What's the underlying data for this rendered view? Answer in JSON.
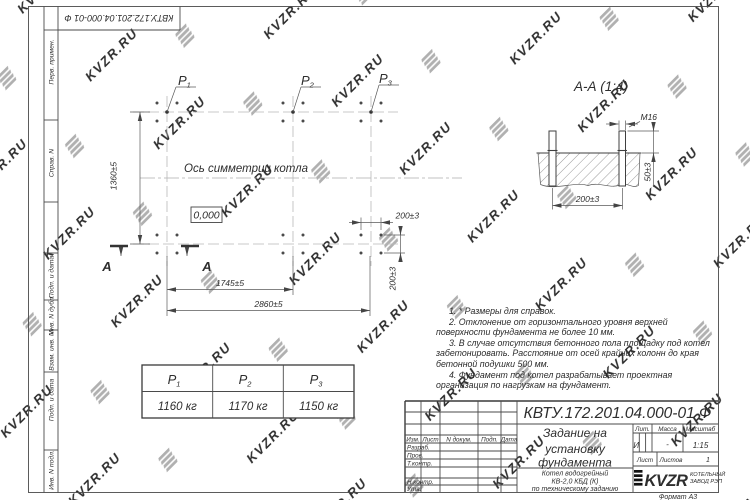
{
  "watermark": {
    "text": "KVZR.RU"
  },
  "designation": "КВТУ.172.201.04.000-01 Ф",
  "margins": {
    "labels": [
      "Перв. примен.",
      "Справ. N",
      "Подп. и дата",
      "Инв. N дубл.",
      "Взам. инв. N",
      "Подп. и дата",
      "Инв. N подл."
    ]
  },
  "plan": {
    "axis_label": "Ось симметрии котла",
    "elevation": "0,000",
    "section_letter": "А",
    "p_labels": [
      {
        "base": "P",
        "sub": "1"
      },
      {
        "base": "P",
        "sub": "2"
      },
      {
        "base": "P",
        "sub": "3"
      }
    ],
    "dims": {
      "height": "1360±5",
      "span_p1_p2": "1745±5",
      "overall": "2860±5",
      "group_x": "200±3",
      "group_y": "200±3"
    }
  },
  "section": {
    "title": "А-А (1:4)",
    "thread": "М16",
    "protrusion": "50±3",
    "spacing": "200±3"
  },
  "load_table": {
    "headers": [
      {
        "base": "P",
        "sub": "1"
      },
      {
        "base": "P",
        "sub": "2"
      },
      {
        "base": "P",
        "sub": "3"
      }
    ],
    "values": [
      "1160 кг",
      "1170 кг",
      "1150 кг"
    ]
  },
  "notes": [
    "1. * Размеры для справок.",
    "2. Отклонение от горизонтального уровня верхней поверхности фундамента не более 10 мм.",
    "3. В случае отсутствия бетонного пола площадку под котел забетонировать. Расстояние от осей крайних колонн до края бетонной подушки 500 мм.",
    "4. Фундамент под котел разрабатывает проектная организация по нагрузкам на фундамент."
  ],
  "title_block": {
    "change_header": [
      "Изм.",
      "Лист",
      "N докум.",
      "Подп.",
      "Дата"
    ],
    "sig_labels": [
      "Разраб.",
      "Пров.",
      "Т.контр.",
      "Н.контр.",
      "Утв."
    ],
    "doc_name_lines": [
      "Задание на",
      "установку",
      "фундамента"
    ],
    "product_lines": [
      "Котел водогрейный",
      "КВ-2,0 КБД (К)",
      "по техническому заданию"
    ],
    "lit_header": "Лит.",
    "lit_value": "И",
    "mass_header": "Масса",
    "mass_value": "-",
    "scale_header": "Масштаб",
    "scale_value": "1:15",
    "sheet_header": "Лист",
    "sheets_header": "Листов",
    "sheets_value": "1",
    "logo_text": "KVZR",
    "logo_caption": [
      "КОТЕЛЬНЫЙ",
      "ЗАВОД РЭП"
    ],
    "format_label": "Формат А3"
  }
}
